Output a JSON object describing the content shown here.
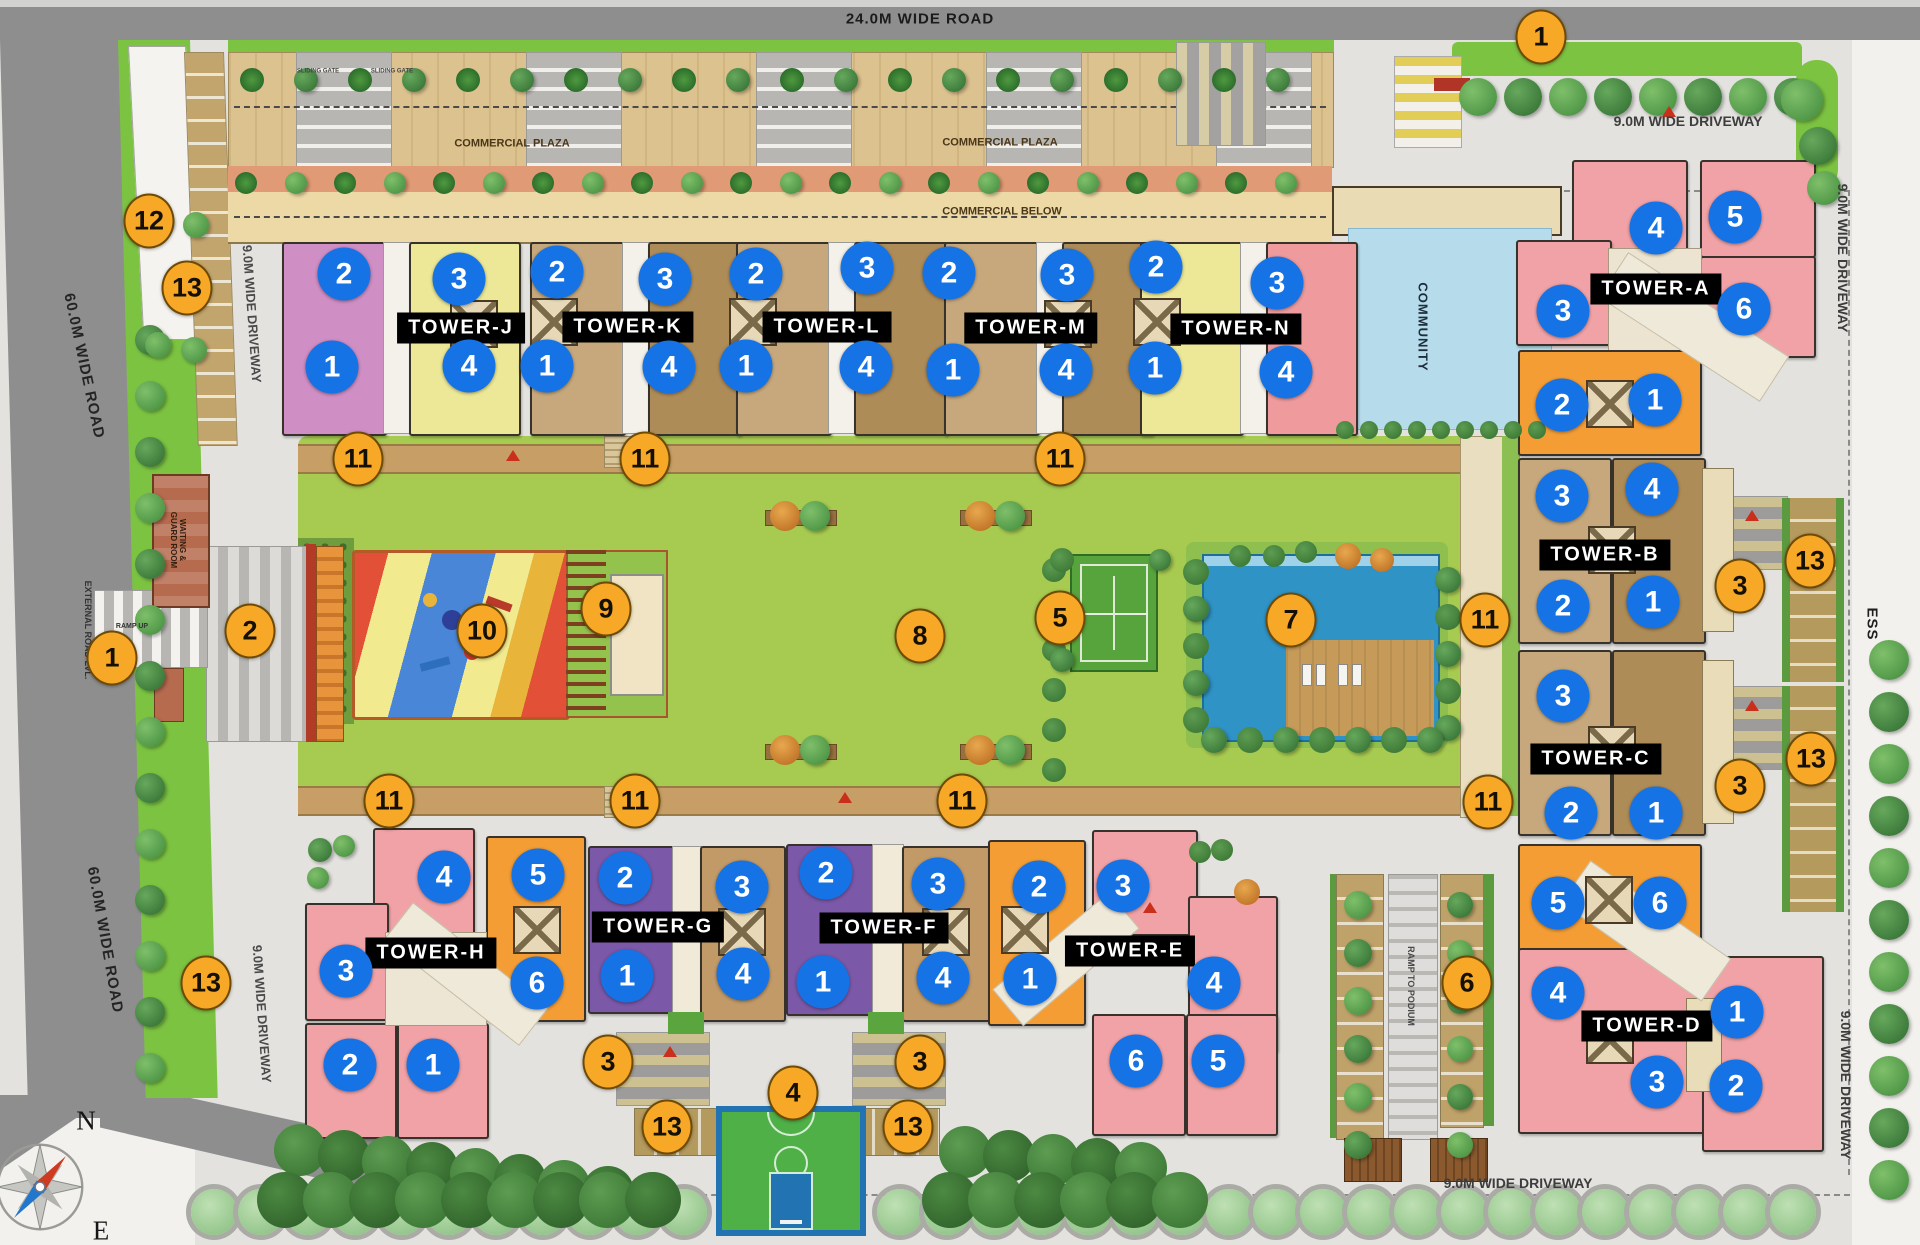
{
  "plan_title": "Residential township site plan",
  "colors": {
    "blue_marker": "#1673e6",
    "orange_marker": "#f7a826",
    "marker_text": "#ffffff",
    "tower_label_bg": "#000000",
    "tower_label_text": "#ffffff",
    "road_dark": "#8e8e8e",
    "driveway": "#e3e2df",
    "grass": "#7cc342",
    "lawn": "#a7ca50",
    "community_water": "#b6dcec",
    "pool_water": "#2f93c5"
  },
  "towers": [
    {
      "name": "TOWER-J",
      "x": 461,
      "y": 328
    },
    {
      "name": "TOWER-K",
      "x": 628,
      "y": 327
    },
    {
      "name": "TOWER-L",
      "x": 827,
      "y": 327
    },
    {
      "name": "TOWER-M",
      "x": 1031,
      "y": 328
    },
    {
      "name": "TOWER-N",
      "x": 1236,
      "y": 329
    },
    {
      "name": "TOWER-A",
      "x": 1656,
      "y": 289
    },
    {
      "name": "TOWER-B",
      "x": 1605,
      "y": 555
    },
    {
      "name": "TOWER-C",
      "x": 1596,
      "y": 759
    },
    {
      "name": "TOWER-D",
      "x": 1647,
      "y": 1026
    },
    {
      "name": "TOWER-E",
      "x": 1130,
      "y": 951
    },
    {
      "name": "TOWER-F",
      "x": 884,
      "y": 928
    },
    {
      "name": "TOWER-G",
      "x": 658,
      "y": 927
    },
    {
      "name": "TOWER-H",
      "x": 431,
      "y": 953
    }
  ],
  "markers": {
    "blue": [
      {
        "n": "2",
        "x": 344,
        "y": 274
      },
      {
        "n": "3",
        "x": 459,
        "y": 279
      },
      {
        "n": "1",
        "x": 332,
        "y": 367
      },
      {
        "n": "4",
        "x": 469,
        "y": 366
      },
      {
        "n": "2",
        "x": 557,
        "y": 272
      },
      {
        "n": "3",
        "x": 665,
        "y": 279
      },
      {
        "n": "1",
        "x": 547,
        "y": 366
      },
      {
        "n": "4",
        "x": 669,
        "y": 367
      },
      {
        "n": "2",
        "x": 756,
        "y": 274
      },
      {
        "n": "3",
        "x": 867,
        "y": 268
      },
      {
        "n": "1",
        "x": 746,
        "y": 366
      },
      {
        "n": "4",
        "x": 866,
        "y": 367
      },
      {
        "n": "2",
        "x": 949,
        "y": 273
      },
      {
        "n": "3",
        "x": 1067,
        "y": 275
      },
      {
        "n": "1",
        "x": 953,
        "y": 370
      },
      {
        "n": "4",
        "x": 1066,
        "y": 370
      },
      {
        "n": "2",
        "x": 1156,
        "y": 267
      },
      {
        "n": "3",
        "x": 1277,
        "y": 283
      },
      {
        "n": "1",
        "x": 1155,
        "y": 368
      },
      {
        "n": "4",
        "x": 1286,
        "y": 372
      },
      {
        "n": "4",
        "x": 1656,
        "y": 228
      },
      {
        "n": "5",
        "x": 1735,
        "y": 217
      },
      {
        "n": "3",
        "x": 1563,
        "y": 311
      },
      {
        "n": "6",
        "x": 1744,
        "y": 309
      },
      {
        "n": "2",
        "x": 1562,
        "y": 405
      },
      {
        "n": "1",
        "x": 1655,
        "y": 400
      },
      {
        "n": "3",
        "x": 1562,
        "y": 496
      },
      {
        "n": "4",
        "x": 1652,
        "y": 489
      },
      {
        "n": "2",
        "x": 1563,
        "y": 606
      },
      {
        "n": "1",
        "x": 1653,
        "y": 602
      },
      {
        "n": "3",
        "x": 1563,
        "y": 696
      },
      {
        "n": "2",
        "x": 1571,
        "y": 813
      },
      {
        "n": "1",
        "x": 1656,
        "y": 813
      },
      {
        "n": "5",
        "x": 1558,
        "y": 903
      },
      {
        "n": "6",
        "x": 1660,
        "y": 903
      },
      {
        "n": "4",
        "x": 1558,
        "y": 993
      },
      {
        "n": "1",
        "x": 1737,
        "y": 1012
      },
      {
        "n": "3",
        "x": 1657,
        "y": 1082
      },
      {
        "n": "2",
        "x": 1736,
        "y": 1086
      },
      {
        "n": "4",
        "x": 444,
        "y": 877
      },
      {
        "n": "5",
        "x": 538,
        "y": 875
      },
      {
        "n": "3",
        "x": 346,
        "y": 971
      },
      {
        "n": "6",
        "x": 537,
        "y": 983
      },
      {
        "n": "2",
        "x": 350,
        "y": 1065
      },
      {
        "n": "1",
        "x": 433,
        "y": 1065
      },
      {
        "n": "2",
        "x": 625,
        "y": 878
      },
      {
        "n": "3",
        "x": 742,
        "y": 887
      },
      {
        "n": "1",
        "x": 627,
        "y": 976
      },
      {
        "n": "4",
        "x": 743,
        "y": 974
      },
      {
        "n": "2",
        "x": 826,
        "y": 873
      },
      {
        "n": "3",
        "x": 938,
        "y": 884
      },
      {
        "n": "1",
        "x": 823,
        "y": 982
      },
      {
        "n": "4",
        "x": 943,
        "y": 978
      },
      {
        "n": "2",
        "x": 1039,
        "y": 887
      },
      {
        "n": "3",
        "x": 1123,
        "y": 886
      },
      {
        "n": "1",
        "x": 1030,
        "y": 979
      },
      {
        "n": "4",
        "x": 1214,
        "y": 983
      },
      {
        "n": "6",
        "x": 1136,
        "y": 1061
      },
      {
        "n": "5",
        "x": 1218,
        "y": 1061
      }
    ],
    "orange": [
      {
        "n": "1",
        "x": 1541,
        "y": 37
      },
      {
        "n": "12",
        "x": 149,
        "y": 221
      },
      {
        "n": "13",
        "x": 187,
        "y": 288
      },
      {
        "n": "11",
        "x": 358,
        "y": 459
      },
      {
        "n": "11",
        "x": 645,
        "y": 459
      },
      {
        "n": "11",
        "x": 1060,
        "y": 459
      },
      {
        "n": "2",
        "x": 250,
        "y": 631
      },
      {
        "n": "1",
        "x": 112,
        "y": 658
      },
      {
        "n": "10",
        "x": 482,
        "y": 631
      },
      {
        "n": "9",
        "x": 606,
        "y": 609
      },
      {
        "n": "8",
        "x": 920,
        "y": 636
      },
      {
        "n": "5",
        "x": 1060,
        "y": 618
      },
      {
        "n": "7",
        "x": 1291,
        "y": 620
      },
      {
        "n": "11",
        "x": 1485,
        "y": 620
      },
      {
        "n": "13",
        "x": 1810,
        "y": 561
      },
      {
        "n": "3",
        "x": 1740,
        "y": 586
      },
      {
        "n": "13",
        "x": 1811,
        "y": 759
      },
      {
        "n": "3",
        "x": 1740,
        "y": 786
      },
      {
        "n": "11",
        "x": 389,
        "y": 801
      },
      {
        "n": "11",
        "x": 635,
        "y": 801
      },
      {
        "n": "11",
        "x": 962,
        "y": 801
      },
      {
        "n": "11",
        "x": 1488,
        "y": 802
      },
      {
        "n": "13",
        "x": 206,
        "y": 983
      },
      {
        "n": "6",
        "x": 1467,
        "y": 983
      },
      {
        "n": "3",
        "x": 608,
        "y": 1062
      },
      {
        "n": "3",
        "x": 920,
        "y": 1062
      },
      {
        "n": "4",
        "x": 793,
        "y": 1093
      },
      {
        "n": "13",
        "x": 667,
        "y": 1127
      },
      {
        "n": "13",
        "x": 908,
        "y": 1127
      }
    ]
  },
  "labels": [
    {
      "text": "24.0M WIDE ROAD",
      "x": 920,
      "y": 19,
      "size": 15,
      "color": "#1b1b1b",
      "ls": 1
    },
    {
      "text": "9.0M WIDE DRIVEWAY",
      "x": 1688,
      "y": 121,
      "size": 14,
      "color": "#3d3d3d"
    },
    {
      "text": "9.0M WIDE DRIVEWAY",
      "x": 1843,
      "y": 258,
      "rot": 90,
      "size": 14,
      "color": "#3d3d3d"
    },
    {
      "text": "9.0M WIDE DRIVEWAY",
      "x": 251,
      "y": 314,
      "rot": 86,
      "size": 13,
      "color": "#4a4a4a"
    },
    {
      "text": "60.0M WIDE ROAD",
      "x": 84,
      "y": 366,
      "rot": 78,
      "size": 15,
      "color": "#242424",
      "ls": 1
    },
    {
      "text": "60.0M WIDE ROAD",
      "x": 105,
      "y": 940,
      "rot": 80,
      "size": 15,
      "color": "#242424",
      "ls": 1
    },
    {
      "text": "9.0M WIDE DRIVEWAY",
      "x": 261,
      "y": 1014,
      "rot": 86,
      "size": 13,
      "color": "#4a4a4a"
    },
    {
      "text": "9.0M WIDE DRIVEWAY",
      "x": 1518,
      "y": 1183,
      "size": 14,
      "color": "#3d3d3d"
    },
    {
      "text": "9.0M WIDE DRIVEWAY",
      "x": 1846,
      "y": 1085,
      "rot": 90,
      "size": 14,
      "color": "#3d3d3d"
    },
    {
      "text": "ESS",
      "x": 1872,
      "y": 624,
      "rot": 90,
      "size": 15,
      "color": "#1f1f1f",
      "ls": 1
    },
    {
      "text": "COMMERCIAL PLAZA",
      "x": 512,
      "y": 144,
      "size": 11,
      "color": "#4a3618"
    },
    {
      "text": "COMMERCIAL PLAZA",
      "x": 1000,
      "y": 143,
      "size": 11,
      "color": "#4a3618"
    },
    {
      "text": "COMMERCIAL BELOW",
      "x": 1002,
      "y": 212,
      "size": 11,
      "color": "#4a3618"
    },
    {
      "text": "COMMUNITY",
      "x": 1422,
      "y": 327,
      "rot": 90,
      "size": 13,
      "color": "#1d2d3a",
      "ls": 1
    },
    {
      "text": "WAITING & GUARD ROOM",
      "x": 178,
      "y": 540,
      "rot": 90,
      "size": 8,
      "color": "#332012",
      "w": 62
    },
    {
      "text": "EXTERNAL ROAD LVL.",
      "x": 88,
      "y": 630,
      "rot": 90,
      "size": 9,
      "color": "#333333"
    },
    {
      "text": "RAMP TO PODIUM",
      "x": 1411,
      "y": 986,
      "rot": 90,
      "size": 9,
      "color": "#474747"
    },
    {
      "text": "RAMP UP",
      "x": 132,
      "y": 627,
      "size": 7,
      "color": "#333333"
    },
    {
      "text": "SLIDING GATE",
      "x": 318,
      "y": 72,
      "size": 6,
      "color": "#444444"
    },
    {
      "text": "SLIDING GATE",
      "x": 392,
      "y": 72,
      "size": 6,
      "color": "#444444"
    },
    {
      "text": "N",
      "x": 86,
      "y": 1121,
      "size": 27,
      "color": "#161616",
      "serif": true
    },
    {
      "text": "E",
      "x": 101,
      "y": 1231,
      "size": 27,
      "color": "#161616",
      "serif": true
    }
  ]
}
